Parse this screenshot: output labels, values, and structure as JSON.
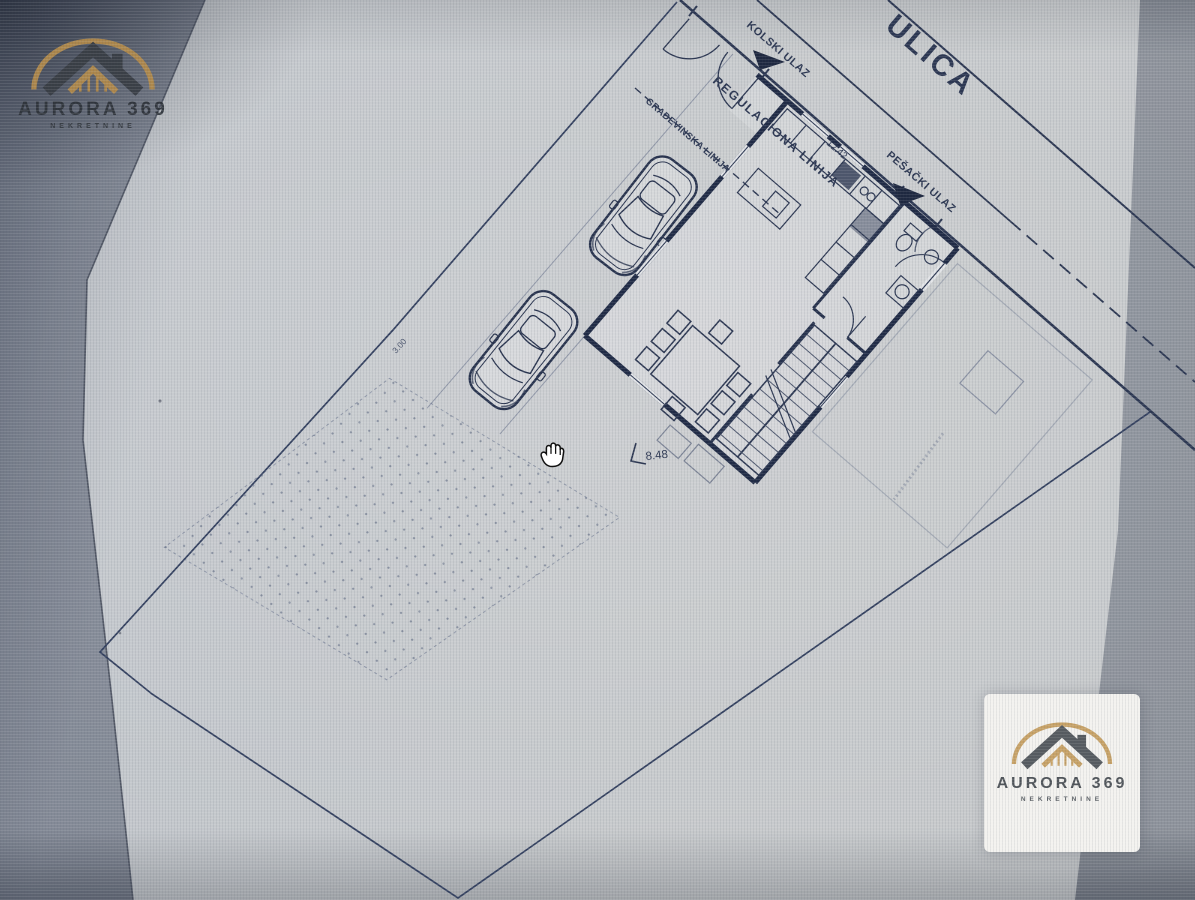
{
  "watermark": {
    "name": "AURORA 369",
    "tagline": "NEKRETNINE",
    "gold": "#c29960",
    "gray": "#565b60"
  },
  "site_plan": {
    "street_name": "ULICA",
    "labels": {
      "vehicle_entrance": "KOLSKI ULAZ",
      "regulation_line": "REGULACIONA LINIJA",
      "building_line": "GRAĐEVINSKA LINIJA",
      "pedestrian_entrance": "PEŠAČKI ULAZ"
    },
    "dimensions": {
      "street_frontage": "12.42",
      "house_setback": "8.48",
      "side_boundary": "3.00"
    },
    "ink_color": "#2c3752",
    "paper_color": "#c3c6ca"
  },
  "cursor": {
    "icon": "hand-grab-cursor"
  }
}
